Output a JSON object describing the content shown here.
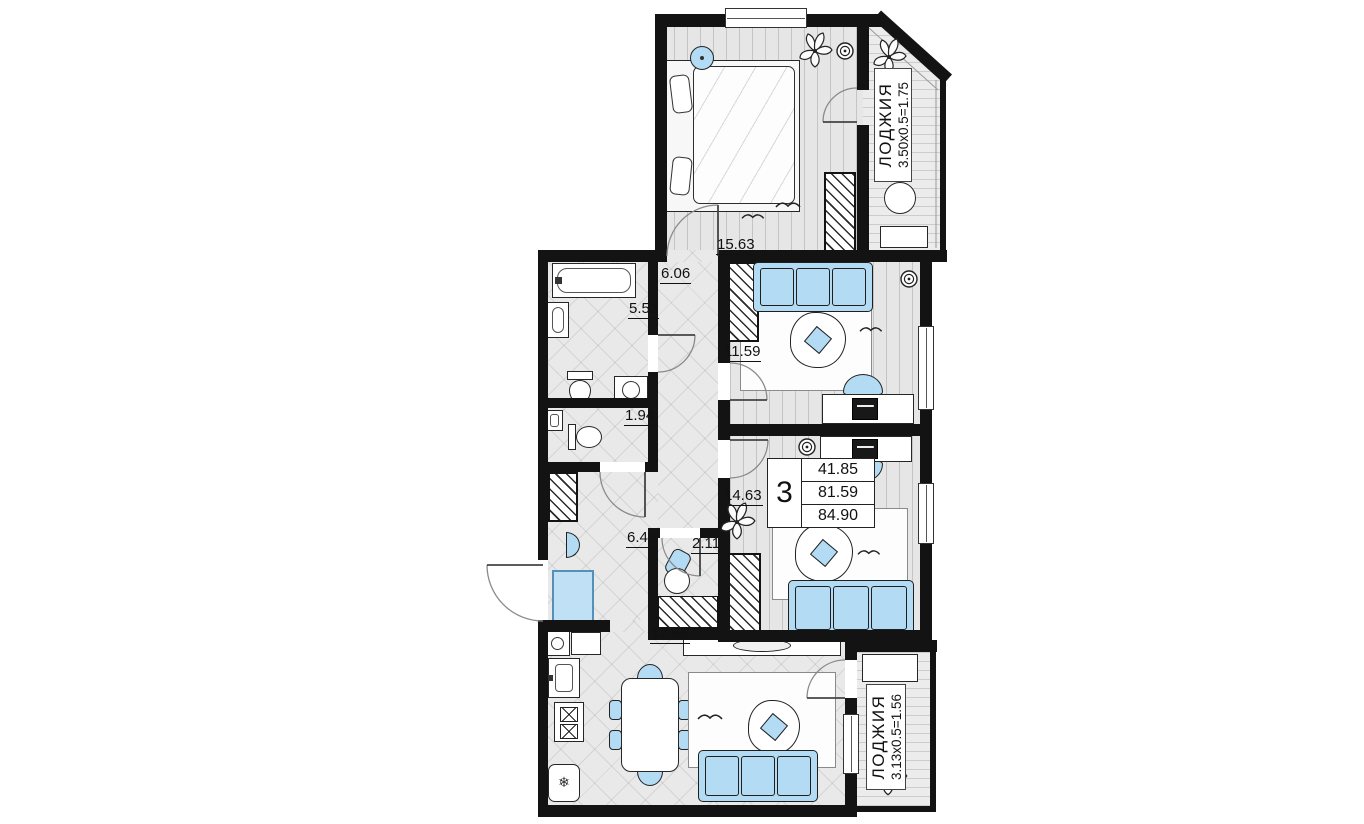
{
  "plan": {
    "info_box": {
      "rooms_count": "3",
      "areas": [
        "41.85",
        "81.59",
        "84.90"
      ]
    },
    "rooms": {
      "bedroom": {
        "area": "15.63"
      },
      "corridor": {
        "area": "6.06"
      },
      "bathroom": {
        "area": "5.53"
      },
      "wc": {
        "area": "1.94"
      },
      "room1": {
        "area": "11.59"
      },
      "room2": {
        "area": "14.63"
      },
      "hallway": {
        "area": "6.45"
      },
      "storage": {
        "area": "2.11"
      },
      "kitchen_living": {
        "area": "17.65"
      }
    },
    "loggias": {
      "top": {
        "name": "ЛОДЖИЯ",
        "dims": "3.50x0.5=1.75"
      },
      "bottom": {
        "name": "ЛОДЖИЯ",
        "dims": "3.13x0.5=1.56"
      }
    },
    "colors": {
      "wall": "#131313",
      "furniture_accent": "#b3dbf3",
      "floor": "#e8e8e8"
    }
  }
}
